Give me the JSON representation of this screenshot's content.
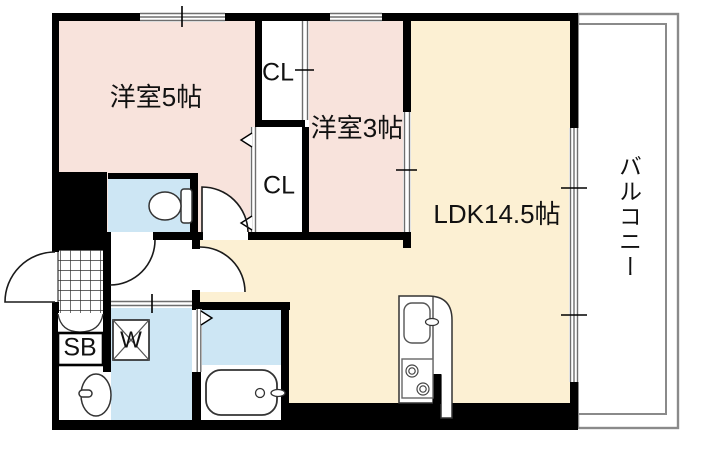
{
  "floorplan": {
    "rooms": {
      "bedroom5": "洋室5帖",
      "bedroom3": "洋室3帖",
      "ldk": "LDK14.5帖",
      "closet_upper": "CL",
      "closet_lower": "CL",
      "balcony": "バルコニー",
      "shoe_box": "SB",
      "washing_machine": "W"
    },
    "colors": {
      "bedroom_fill": "#f8e3dc",
      "ldk_fill": "#fcf0d3",
      "wet_area_fill": "#cde6f4",
      "wall": "#000000",
      "balcony_line": "#8a8a8a",
      "window_line": "#6e6e6e"
    }
  }
}
